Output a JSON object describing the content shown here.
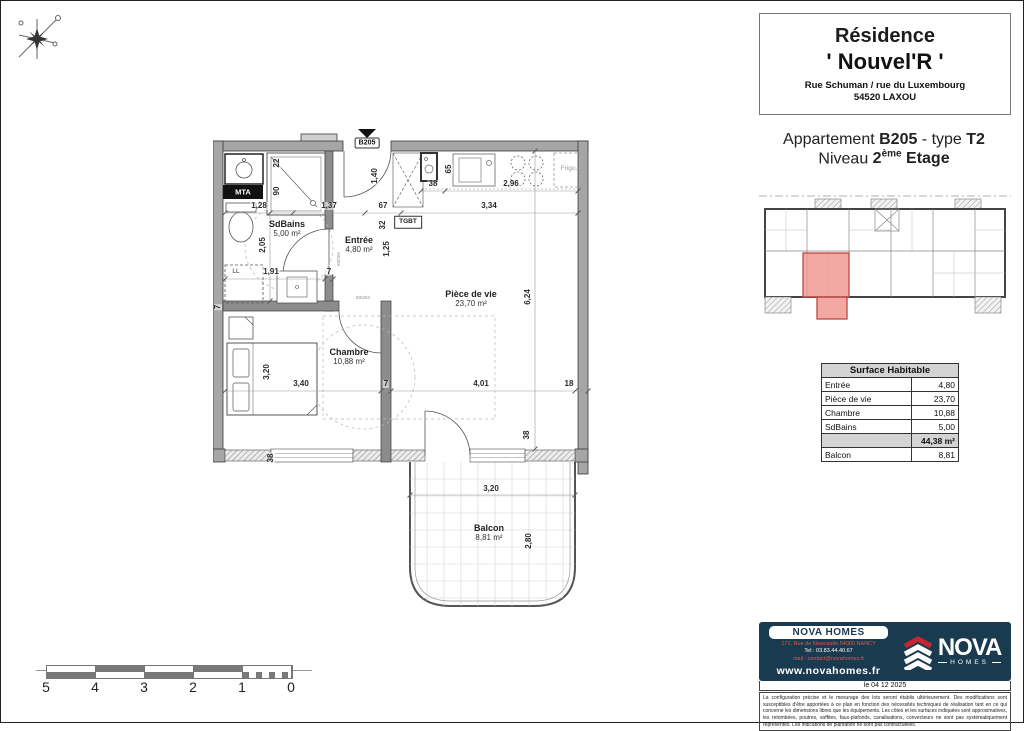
{
  "header": {
    "residence_label": "Résidence",
    "residence_name": "' Nouvel'R '",
    "address_line1": "Rue Schuman / rue du Luxembourg",
    "address_line2": "54520 LAXOU",
    "apartment_prefix": "Appartement ",
    "apartment_code": "B205",
    "apartment_mid": " - type ",
    "apartment_type": "T2",
    "level_prefix": "Niveau ",
    "level_value": "2",
    "level_sup": "ème",
    "level_suffix": " Etage"
  },
  "plan": {
    "unit_tag": "B205",
    "rooms": [
      {
        "name": "SdBains",
        "area": "5,00 m²",
        "x": 74,
        "y": 100
      },
      {
        "name": "Entrée",
        "area": "4,80 m²",
        "x": 146,
        "y": 116
      },
      {
        "name": "Pièce de vie",
        "area": "23,70 m²",
        "x": 258,
        "y": 170
      },
      {
        "name": "Chambre",
        "area": "10,88 m²",
        "x": 136,
        "y": 228
      },
      {
        "name": "Balcon",
        "area": "8,81 m²",
        "x": 276,
        "y": 404
      }
    ],
    "tags": [
      {
        "t": "MTA",
        "cls": "mta",
        "x": 30,
        "y": 63
      },
      {
        "t": "LL",
        "cls": "small",
        "x": 23,
        "y": 143
      },
      {
        "t": "TGBT",
        "cls": "tgbt",
        "x": 195,
        "y": 93
      },
      {
        "t": "Frigo.",
        "cls": "frigo",
        "x": 356,
        "y": 40
      },
      {
        "t": "B205",
        "cls": "b205",
        "x": 154,
        "y": 14
      },
      {
        "t": "83/204",
        "cls": "doorspec",
        "x": 126,
        "y": 130,
        "r": 1
      },
      {
        "t": "83/204",
        "cls": "doorspec",
        "x": 150,
        "y": 169
      }
    ],
    "dims": [
      {
        "t": "22",
        "x": 64,
        "y": 34,
        "r": 1
      },
      {
        "t": "90",
        "x": 64,
        "y": 62,
        "r": 1
      },
      {
        "t": "1,28",
        "x": 46,
        "y": 77
      },
      {
        "t": "1,37",
        "x": 116,
        "y": 77
      },
      {
        "t": "67",
        "x": 170,
        "y": 77
      },
      {
        "t": "3,34",
        "x": 276,
        "y": 77
      },
      {
        "t": "38",
        "x": 220,
        "y": 55
      },
      {
        "t": "2,96",
        "x": 298,
        "y": 55
      },
      {
        "t": "65",
        "x": 236,
        "y": 40,
        "r": 1
      },
      {
        "t": "1,40",
        "x": 162,
        "y": 47,
        "r": 1
      },
      {
        "t": "32",
        "x": 170,
        "y": 96,
        "r": 1
      },
      {
        "t": "2,05",
        "x": 50,
        "y": 116,
        "r": 1
      },
      {
        "t": "1,25",
        "x": 174,
        "y": 120,
        "r": 1
      },
      {
        "t": "1,91",
        "x": 58,
        "y": 143
      },
      {
        "t": "7",
        "x": 116,
        "y": 143
      },
      {
        "t": "7",
        "x": 5,
        "y": 178,
        "r": 1
      },
      {
        "t": "6,24",
        "x": 315,
        "y": 168,
        "r": 1
      },
      {
        "t": "3,20",
        "x": 54,
        "y": 243,
        "r": 1
      },
      {
        "t": "3,40",
        "x": 88,
        "y": 255
      },
      {
        "t": "7",
        "x": 173,
        "y": 255
      },
      {
        "t": "4,01",
        "x": 268,
        "y": 255
      },
      {
        "t": "18",
        "x": 356,
        "y": 255
      },
      {
        "t": "38",
        "x": 58,
        "y": 329,
        "r": 1
      },
      {
        "t": "38",
        "x": 314,
        "y": 306,
        "r": 1
      },
      {
        "t": "3,20",
        "x": 278,
        "y": 360
      },
      {
        "t": "2,80",
        "x": 316,
        "y": 412,
        "r": 1
      }
    ]
  },
  "surface_table": {
    "title": "Surface Habitable",
    "rows": [
      [
        "Entrée",
        "4,80"
      ],
      [
        "Pièce de vie",
        "23,70"
      ],
      [
        "Chambre",
        "10,88"
      ],
      [
        "SdBains",
        "5,00"
      ]
    ],
    "total": "44,38 m²",
    "balcon_row": [
      "Balcon",
      "8,81"
    ]
  },
  "scalebar": {
    "labels": [
      "5",
      "4",
      "3",
      "2",
      "1",
      "0"
    ]
  },
  "footer": {
    "company": "NOVA HOMES",
    "address": "171, Rue de Newcastle 54000 NANCY",
    "tel": "Tel : 03.83.44.40.67",
    "mail": "mail : contact@novahomes.fr",
    "site": "www.novahomes.fr",
    "logo_name": "NOVA",
    "logo_sub": "HOMES",
    "date": "le 04 12 2025",
    "disclaimer": "La configuration précise et le mesurage des lots seront établis ultérieurement. Des modifications sont susceptibles d'être apportées à ce plan en fonction des nécessités techniques de réalisation tant en ce qui concerne les dimensions libres que les équipements. Les côtes et les surfaces indiquées sont approximatives, les retombées, poutres, soffites, faux-plafonds, canalisations, convecteurs ne sont pas systématiquement représentés. Les indications de plantation ne sont pas contractuelles."
  },
  "colors": {
    "navy": "#1a3a50",
    "logo_red": "#c4272e",
    "highlight_unit": "#f0928d",
    "wall_gray": "#a6a6a6"
  }
}
